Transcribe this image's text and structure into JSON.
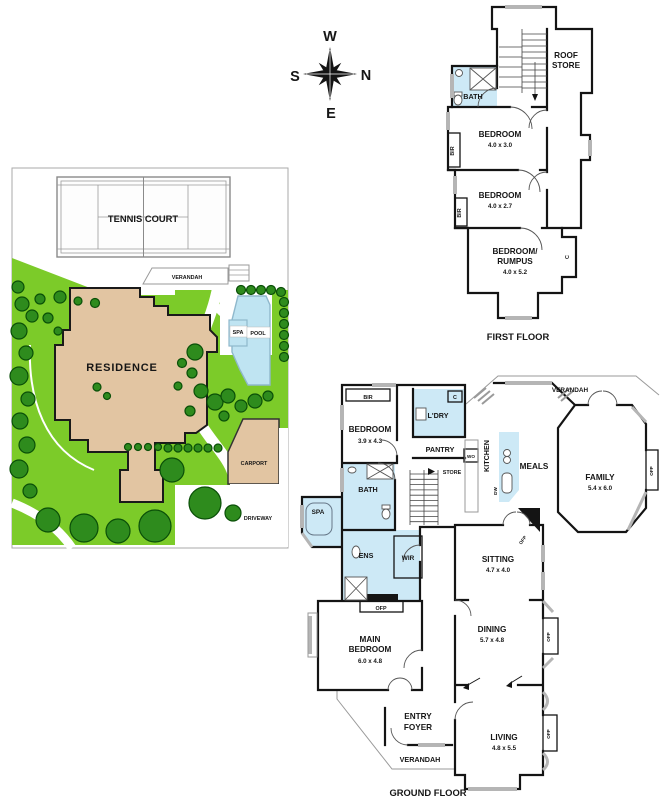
{
  "compass": {
    "w": "W",
    "n": "N",
    "s": "S",
    "e": "E"
  },
  "site": {
    "tennis_court": "TENNIS COURT",
    "verandah": "VERANDAH",
    "residence": "RESIDENCE",
    "spa": "SPA",
    "pool": "POOL",
    "carport": "CARPORT",
    "driveway": "DRIVEWAY"
  },
  "first_floor": {
    "title": "FIRST FLOOR",
    "roof_1": "ROOF",
    "roof_2": "STORE",
    "bath": "BATH",
    "bed1_name": "BEDROOM",
    "bed1_dims": "4.0 x 3.0",
    "bed2_name": "BEDROOM",
    "bed2_dims": "4.0 x 2.7",
    "rumpus_1": "BEDROOM/",
    "rumpus_2": "RUMPUS",
    "rumpus_dims": "4.0 x 5.2",
    "bir1": "BIR",
    "bir2": "BIR",
    "c": "C"
  },
  "ground_floor": {
    "title": "GROUND FLOOR",
    "bir": "BIR",
    "bedroom_name": "BEDROOM",
    "bedroom_dims": "3.9 x 4.3",
    "ldry": "L'DRY",
    "c": "C",
    "pantry": "PANTRY",
    "wo": "WO",
    "kitchen": "KITCHEN",
    "store": "STORE",
    "dw": "DW",
    "meals": "MEALS",
    "verandah_top": "VERANDAH",
    "family_name": "FAMILY",
    "family_dims": "5.4 x 6.0",
    "ofp_family": "OFP",
    "bath": "BATH",
    "spa": "SPA",
    "ens": "ENS",
    "wir": "WIR",
    "ofp_main": "OFP",
    "ofp_sitting": "OFP",
    "main_1": "MAIN",
    "main_2": "BEDROOM",
    "main_dims": "6.0 x 4.8",
    "sitting_name": "SITTING",
    "sitting_dims": "4.7 x 4.0",
    "dining_name": "DINING",
    "dining_dims": "5.7 x 4.8",
    "ofp_dining": "OFP",
    "entry_1": "ENTRY",
    "entry_2": "FOYER",
    "living_name": "LIVING",
    "living_dims": "4.8 x 5.5",
    "ofp_living": "OFP",
    "verandah_bottom": "VERANDAH"
  },
  "colors": {
    "lawn": "#7ccb29",
    "tree": "#2e8b1d",
    "tree_edge": "#0a4f08",
    "building": "#e2c5a2",
    "pool": "#bfe4f2",
    "wet_area": "#cde9f6",
    "wall": "#141414",
    "window": "#b5b5b5"
  }
}
